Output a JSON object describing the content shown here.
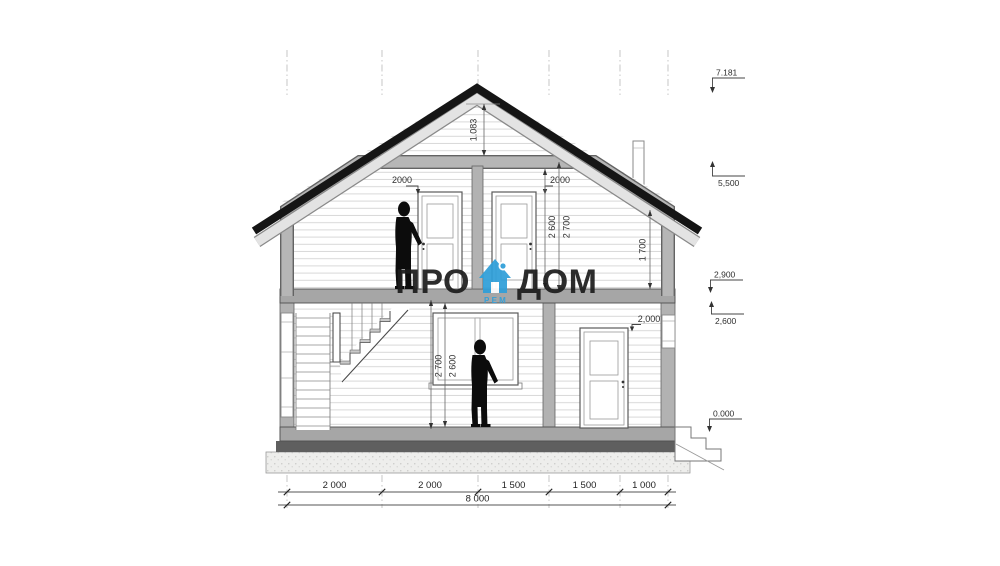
{
  "watermark": {
    "word_left": "ПРО",
    "word_right": "ДОМ",
    "sub": "РЕМ",
    "brand_blue": "#2f9fd9",
    "text_color": "#1d1d1d"
  },
  "elevations": {
    "ridge": "7.181",
    "ceiling_level": "5,500",
    "second_floor_level": "2,900",
    "first_ceiling_level": "2,600",
    "ground_floor_level": "0.000"
  },
  "dimensions": {
    "ridge_to_ceiling": "1.083",
    "door_2f_left_height": "2000",
    "door_2f_right_height": "2000",
    "door_1f_height": "2,000",
    "floor2_clear_height": "2 600",
    "floor2_structural_height": "2 700",
    "knee_wall_height": "1 700",
    "floor1_structural_height": "2 700",
    "floor1_clear_height": "2 600",
    "bottom_segments": [
      "2 000",
      "2 000",
      "1 500",
      "1 500",
      "1 000"
    ],
    "overall_width": "8 000"
  },
  "colors": {
    "structure_band": "#b2b2b2",
    "floor_band": "#a6a6a6",
    "roof_black": "#151515",
    "plinth": "#5f5f5f"
  }
}
